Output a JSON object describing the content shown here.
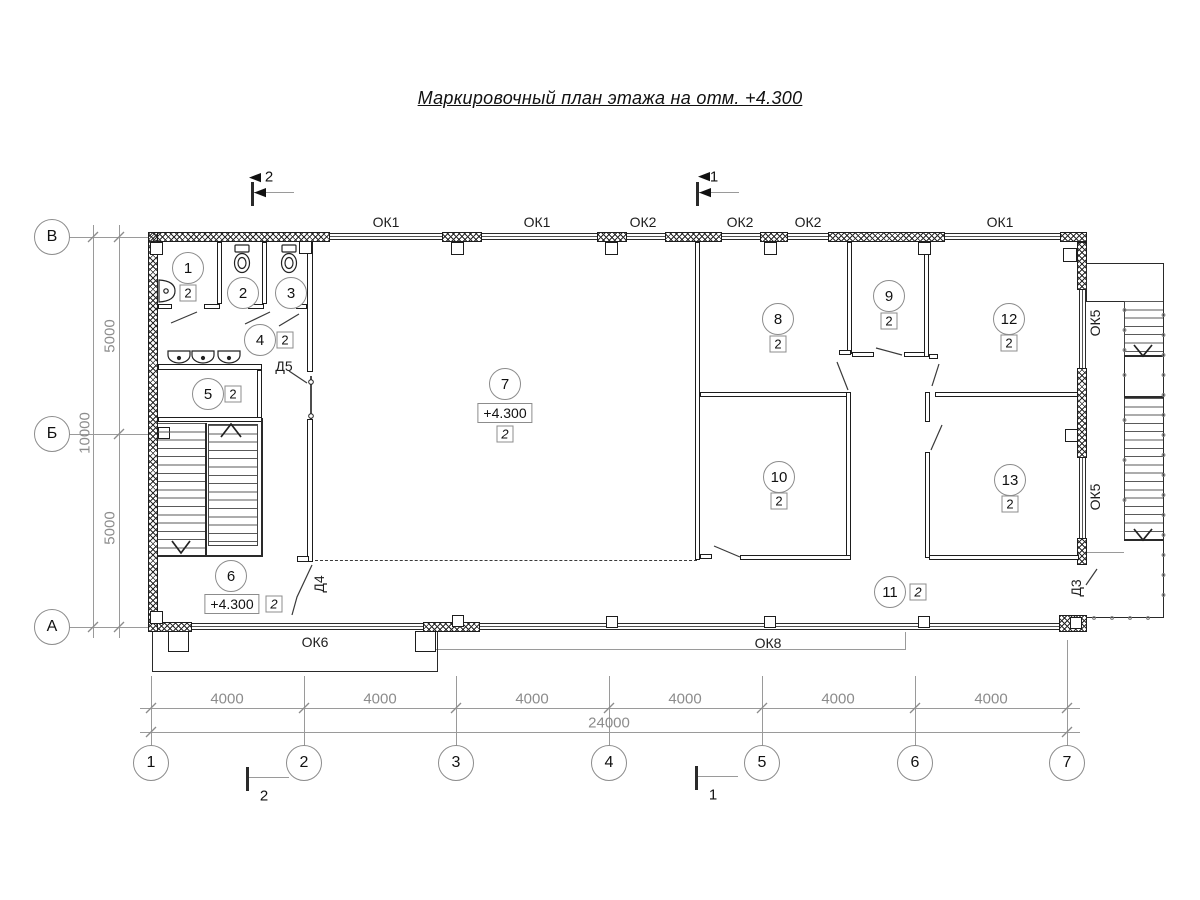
{
  "title": "Маркировочный план этажа на отм. +4.300",
  "elevation": "+4.300",
  "axes": {
    "rows": [
      {
        "label": "В"
      },
      {
        "label": "Б"
      },
      {
        "label": "А"
      }
    ],
    "cols": [
      {
        "label": "1"
      },
      {
        "label": "2"
      },
      {
        "label": "3"
      },
      {
        "label": "4"
      },
      {
        "label": "5"
      },
      {
        "label": "6"
      },
      {
        "label": "7"
      }
    ]
  },
  "dims": {
    "left_segments": [
      {
        "value": "5000"
      },
      {
        "value": "5000"
      }
    ],
    "left_total": "10000",
    "bottom_segments": [
      {
        "value": "4000"
      },
      {
        "value": "4000"
      },
      {
        "value": "4000"
      },
      {
        "value": "4000"
      },
      {
        "value": "4000"
      },
      {
        "value": "4000"
      }
    ],
    "bottom_total": "24000"
  },
  "sections": {
    "top_left": "2",
    "top_right": "1",
    "bottom_left": "2",
    "bottom_right": "1"
  },
  "windows": {
    "top": [
      {
        "label": "ОК1"
      },
      {
        "label": "ОК1"
      },
      {
        "label": "ОК2"
      },
      {
        "label": "ОК2"
      },
      {
        "label": "ОК2"
      },
      {
        "label": "ОК1"
      }
    ],
    "bottom": [
      {
        "label": "ОК6"
      },
      {
        "label": "ОК8"
      }
    ],
    "right": [
      {
        "label": "ОК5"
      },
      {
        "label": "ОК5"
      }
    ]
  },
  "doors": {
    "d5": "Д5",
    "d4": "Д4",
    "d3": "Д3"
  },
  "rooms": [
    {
      "num": "1",
      "mark": "2"
    },
    {
      "num": "2"
    },
    {
      "num": "3"
    },
    {
      "num": "4",
      "mark": "2"
    },
    {
      "num": "5",
      "mark": "2"
    },
    {
      "num": "6",
      "mark": "2",
      "elevation": "+4.300"
    },
    {
      "num": "7",
      "mark": "2",
      "elevation": "+4.300"
    },
    {
      "num": "8",
      "mark": "2"
    },
    {
      "num": "9",
      "mark": "2"
    },
    {
      "num": "10",
      "mark": "2"
    },
    {
      "num": "11",
      "mark": "2"
    },
    {
      "num": "12",
      "mark": "2"
    },
    {
      "num": "13",
      "mark": "2"
    }
  ]
}
